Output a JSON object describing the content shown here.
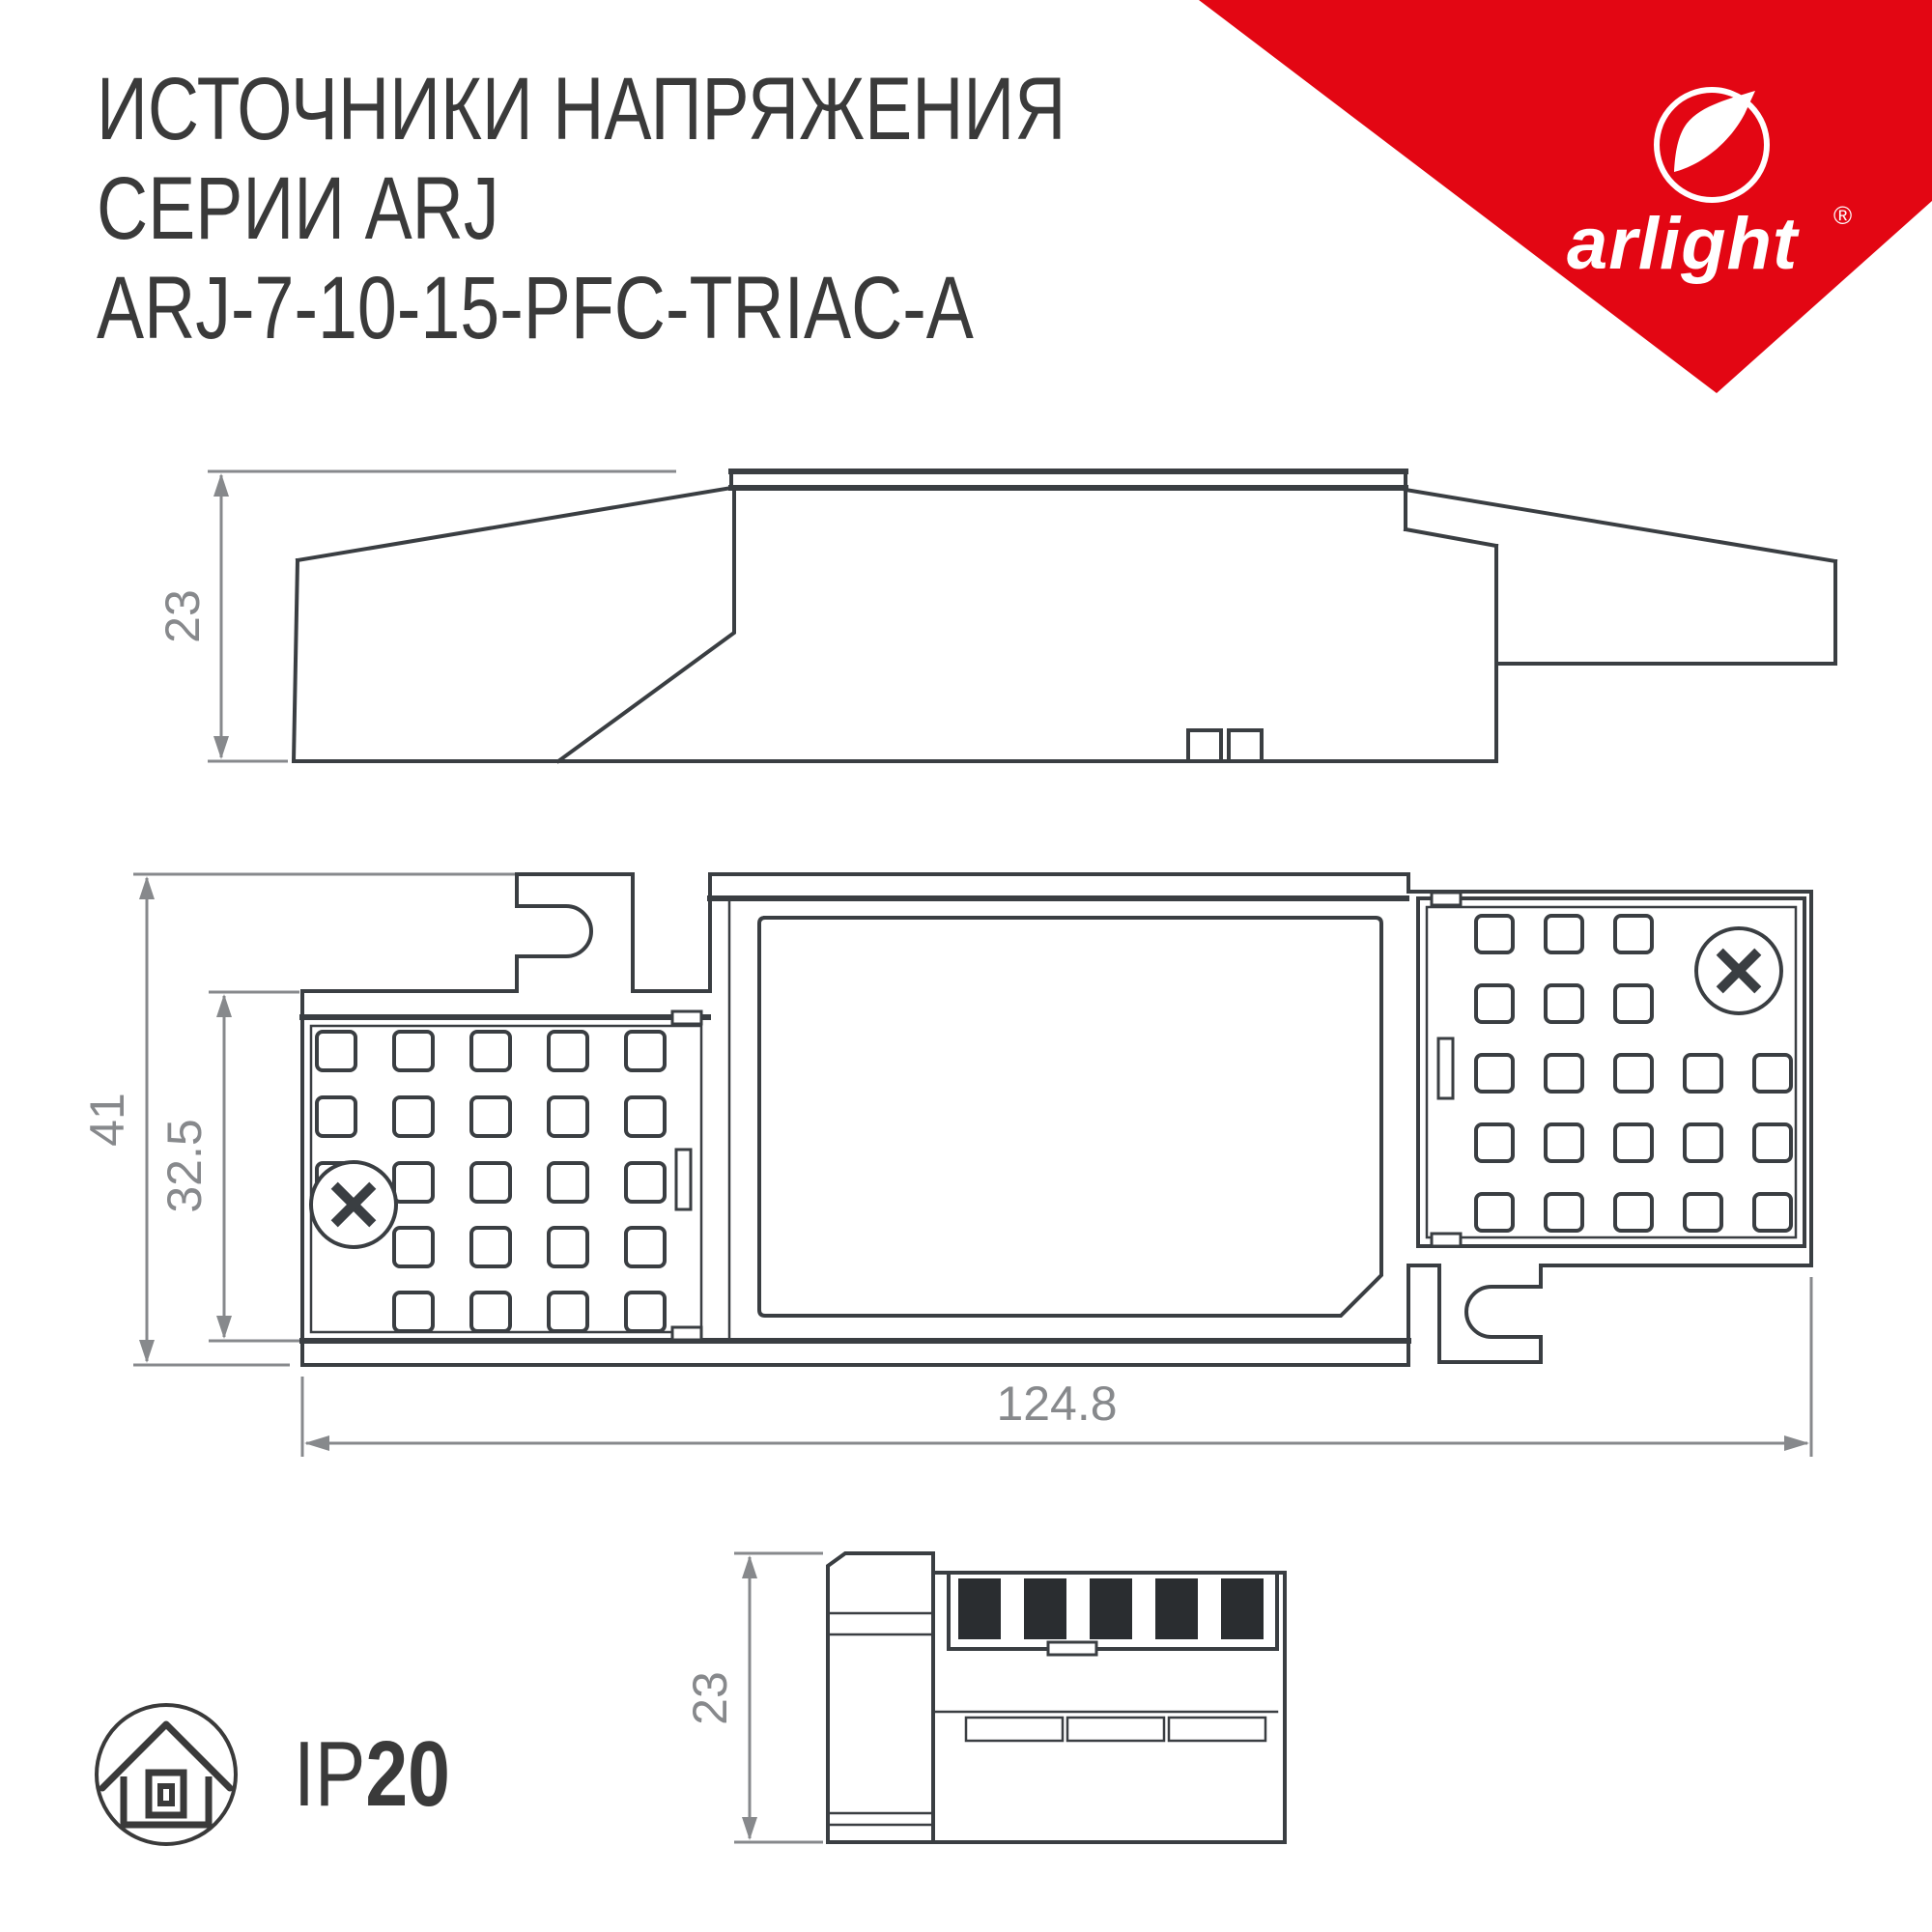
{
  "header": {
    "title_line1": "ИСТОЧНИКИ НАПРЯЖЕНИЯ",
    "title_line2": "СЕРИИ ARJ",
    "title_line3": "ARJ-7-10-15-PFC-TRIAC-A"
  },
  "logo": {
    "brand": "arlight",
    "registered": "®"
  },
  "dimensions": {
    "side_height_mm": "23",
    "overall_width_mm": "41",
    "body_width_mm": "32.5",
    "length_mm": "124.8",
    "end_height_mm": "23"
  },
  "badge": {
    "ip_prefix": "IP",
    "ip_value": "20"
  },
  "colors": {
    "accent_red": "#E30613",
    "line_dark": "#3A3E42",
    "dim_gray": "#87898C",
    "text_dark": "#3A3A3A",
    "terminal_black": "#2A2D30"
  }
}
